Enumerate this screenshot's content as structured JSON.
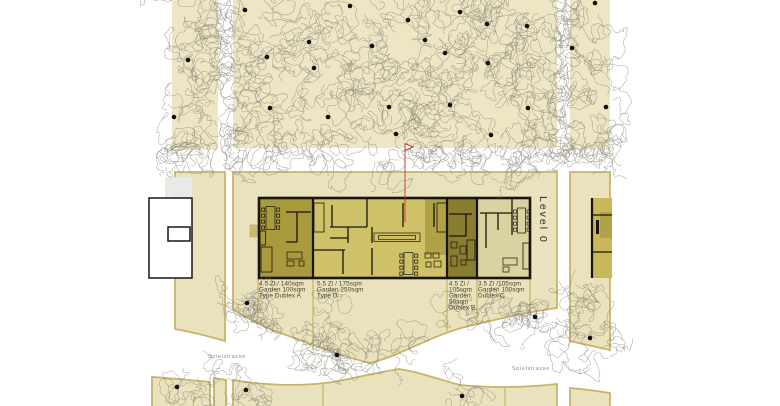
{
  "labels": {
    "level": "Level 0",
    "street_left": "Spielstrasse",
    "street_right": "Spielstrasse"
  },
  "units": [
    {
      "id": "type-dublex-a",
      "color": "#a89a3d",
      "lines": [
        "4.5 Zi / 140sqm",
        "Garden 100sqm",
        "Type Dublex A"
      ]
    },
    {
      "id": "type-d",
      "color": "#cfc167",
      "lines": [
        "5.5 Zi / 175sqm",
        "Garden 250sqm",
        "Type D"
      ]
    },
    {
      "id": "dublex-b",
      "color": "#8a7c30",
      "lines": [
        "4.5 Zi /",
        "105sqm",
        "Garden",
        "50sqm",
        "Dublex B"
      ]
    },
    {
      "id": "dublex-c",
      "color": "#dbd2a2",
      "lines": [
        "3.5 Zi /105sqm",
        "Garden 100sqm",
        "Dublex C"
      ]
    }
  ],
  "colors": {
    "paper": "#ffffff",
    "ground": "#ede5c3",
    "plot": "#eae2bc",
    "plotBorder": "#c9b26b",
    "wall": "#17150c",
    "unitDdark": "#b0a246",
    "miniBuilding": "#c9b75a",
    "grayBlock": "#e9e9e7",
    "scribble": "#8f8c80",
    "scribbleDark": "#6f6d64",
    "dot": "#101010",
    "flag": "#c0392b",
    "annText": "#45422f",
    "streetText": "#8d897b",
    "levelText": "#2f2d24",
    "porch": "#cdb96a"
  },
  "marker": {
    "x": 405,
    "flag_top": 143.5,
    "pole_bottom": 222
  },
  "trees": {
    "fields": [
      [
        172,
        0,
        46,
        150
      ],
      [
        233,
        0,
        324,
        148
      ],
      [
        570,
        0,
        40,
        150
      ]
    ],
    "dots": [
      [
        245,
        10
      ],
      [
        350,
        6
      ],
      [
        408,
        20
      ],
      [
        460,
        12
      ],
      [
        487,
        24
      ],
      [
        527,
        26
      ],
      [
        595,
        3
      ],
      [
        188,
        60
      ],
      [
        267,
        57
      ],
      [
        309,
        42
      ],
      [
        372,
        46
      ],
      [
        425,
        40
      ],
      [
        445,
        53
      ],
      [
        488,
        63
      ],
      [
        572,
        48
      ],
      [
        314,
        68
      ],
      [
        174,
        117
      ],
      [
        270,
        108
      ],
      [
        328,
        117
      ],
      [
        389,
        107
      ],
      [
        450,
        105
      ],
      [
        528,
        108
      ],
      [
        491,
        135
      ],
      [
        396,
        134
      ],
      [
        606,
        107
      ],
      [
        247,
        303
      ],
      [
        337,
        355
      ],
      [
        535,
        317
      ],
      [
        590,
        338
      ],
      [
        177,
        387
      ],
      [
        246,
        390
      ],
      [
        462,
        396
      ]
    ],
    "clusters": [
      [
        224,
        45,
        9
      ],
      [
        226,
        85,
        11
      ],
      [
        224,
        125,
        11
      ],
      [
        561,
        25,
        9
      ],
      [
        560,
        70,
        11
      ],
      [
        562,
        115,
        11
      ],
      [
        564,
        145,
        9
      ],
      [
        176,
        150,
        8
      ],
      [
        200,
        152,
        8
      ],
      [
        237,
        150,
        9
      ],
      [
        300,
        150,
        8
      ],
      [
        430,
        151,
        10
      ],
      [
        470,
        154,
        12
      ],
      [
        505,
        158,
        11
      ],
      [
        530,
        152,
        8
      ],
      [
        560,
        150,
        10
      ],
      [
        598,
        150,
        12
      ],
      [
        610,
        158,
        8
      ],
      [
        230,
        300,
        10
      ],
      [
        250,
        305,
        10
      ],
      [
        262,
        302,
        8
      ],
      [
        330,
        302,
        10
      ],
      [
        244,
        300,
        8
      ],
      [
        247,
        312,
        10
      ],
      [
        268,
        325,
        12
      ],
      [
        300,
        340,
        14
      ],
      [
        322,
        352,
        16
      ],
      [
        337,
        352,
        20
      ],
      [
        360,
        362,
        14
      ],
      [
        390,
        352,
        12
      ],
      [
        410,
        340,
        10
      ],
      [
        455,
        300,
        10
      ],
      [
        460,
        300,
        8
      ],
      [
        480,
        310,
        12
      ],
      [
        505,
        315,
        14
      ],
      [
        525,
        322,
        12
      ],
      [
        535,
        320,
        14
      ],
      [
        552,
        332,
        12
      ],
      [
        565,
        345,
        10
      ],
      [
        575,
        290,
        10
      ],
      [
        585,
        310,
        14
      ],
      [
        590,
        340,
        14
      ],
      [
        605,
        352,
        10
      ],
      [
        222,
        370,
        8
      ],
      [
        177,
        385,
        12
      ],
      [
        195,
        395,
        10
      ],
      [
        246,
        388,
        13
      ],
      [
        262,
        398,
        10
      ],
      [
        455,
        393,
        10
      ],
      [
        470,
        398,
        8
      ]
    ]
  }
}
